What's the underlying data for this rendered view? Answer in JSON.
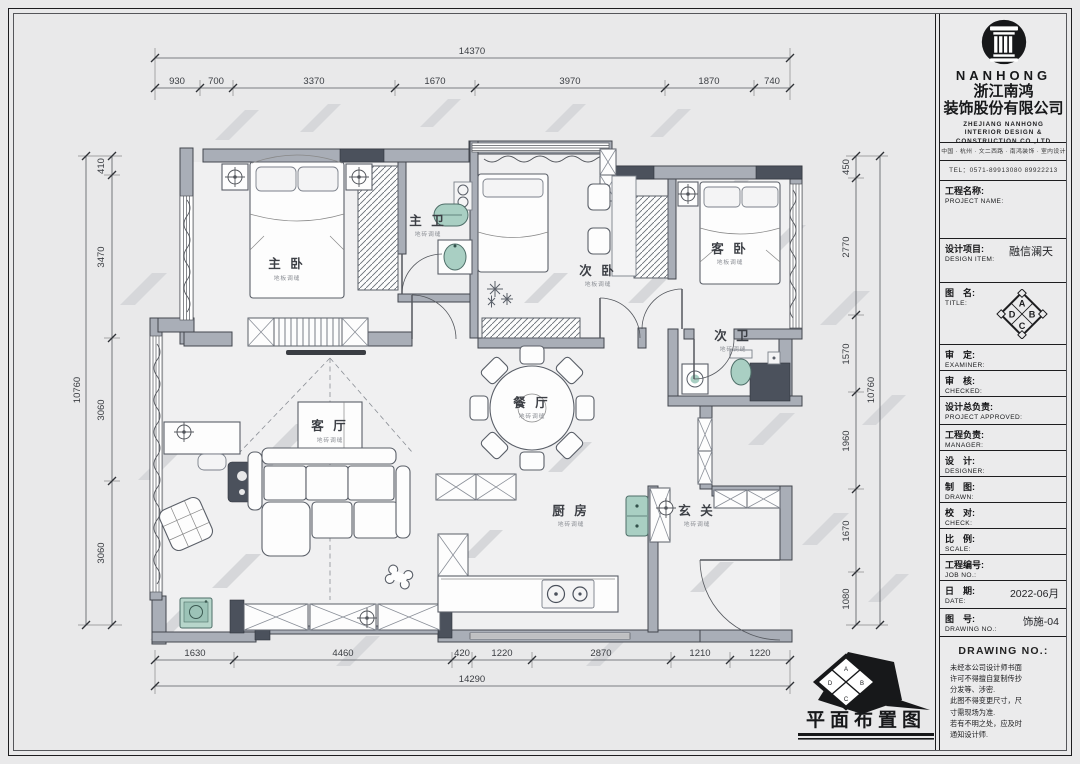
{
  "sheet": {
    "stamp_title": "平面布置图"
  },
  "title_block": {
    "brand": {
      "name_en": "NANHONG",
      "name_cn_line1": "浙江南鸿",
      "name_cn_line2": "装饰股份有限公司",
      "subtitle_line1": "ZHEJIANG NANHONG",
      "subtitle_line2": "INTERIOR DESIGN &",
      "subtitle_line3": "CONSTRUCTION CO.,LTD",
      "address": "中国 · 杭州 · 文二西路 · 南鸿装饰 · 室内设计",
      "tel": "TEL：0571-89913080  89922213"
    },
    "fields": [
      {
        "cn": "工程名称:",
        "en": "PROJECT NAME:",
        "value": ""
      },
      {
        "cn": "设计项目:",
        "en": "DESIGN ITEM:",
        "value": "融信澜天"
      },
      {
        "cn": "图　名:",
        "en": "TITLE:",
        "value": ""
      },
      {
        "cn": "审　定:",
        "en": "EXAMINER:",
        "value": ""
      },
      {
        "cn": "审　核:",
        "en": "CHECKED:",
        "value": ""
      },
      {
        "cn": "设计总负责:",
        "en": "PROJECT APPROVED:",
        "value": ""
      },
      {
        "cn": "工程负责:",
        "en": "MANAGER:",
        "value": ""
      },
      {
        "cn": "设　计:",
        "en": "DESIGNER:",
        "value": ""
      },
      {
        "cn": "制　图:",
        "en": "DRAWN:",
        "value": ""
      },
      {
        "cn": "校　对:",
        "en": "CHECK:",
        "value": ""
      },
      {
        "cn": "比　例:",
        "en": "SCALE:",
        "value": ""
      },
      {
        "cn": "工程编号:",
        "en": "JOB NO.:",
        "value": ""
      },
      {
        "cn": "日　期:",
        "en": "DATE:",
        "value": "2022-06月"
      },
      {
        "cn": "图　号:",
        "en": "DRAWING NO.:",
        "value": "饰施-04"
      }
    ],
    "diamond_letters": [
      "A",
      "B",
      "C",
      "D"
    ],
    "notes_header": "DRAWING NO.:",
    "notes_lines": [
      "未经本公司设计师书面",
      "许可不得擅自复制传抄",
      "分发等、涉密.",
      "此图不得变更尺寸，尺",
      "寸需现场为准.",
      "若有不明之处，应及时",
      "通知设计师."
    ]
  },
  "plan": {
    "rooms": [
      {
        "name": "主 卧",
        "sub": "地板调缝"
      },
      {
        "name": "主 卫",
        "sub": "地砖调缝"
      },
      {
        "name": "次 卧",
        "sub": "地板调缝"
      },
      {
        "name": "客 卧",
        "sub": "地板调缝"
      },
      {
        "name": "次 卫",
        "sub": "地砖调缝"
      },
      {
        "name": "餐 厅",
        "sub": "地砖调缝"
      },
      {
        "name": "客 厅",
        "sub": "地砖调缝"
      },
      {
        "name": "厨 房",
        "sub": "地砖调缝"
      },
      {
        "name": "玄 关",
        "sub": "地砖调缝"
      }
    ],
    "dims": {
      "top": {
        "total": "14370",
        "segments": [
          "930",
          "700",
          "3370",
          "1670",
          "3970",
          "1870",
          "740"
        ]
      },
      "bottom": {
        "total": "14290",
        "segments": [
          "1630",
          "4460",
          "420",
          "1220",
          "2870",
          "1210",
          "1220"
        ]
      },
      "left": {
        "total": "10760",
        "segments": [
          "410",
          "3470",
          "3060",
          "3060"
        ]
      },
      "right": {
        "total": "10760",
        "segments": [
          "450",
          "2770",
          "1570",
          "1960",
          "1670",
          "1080"
        ]
      }
    }
  }
}
